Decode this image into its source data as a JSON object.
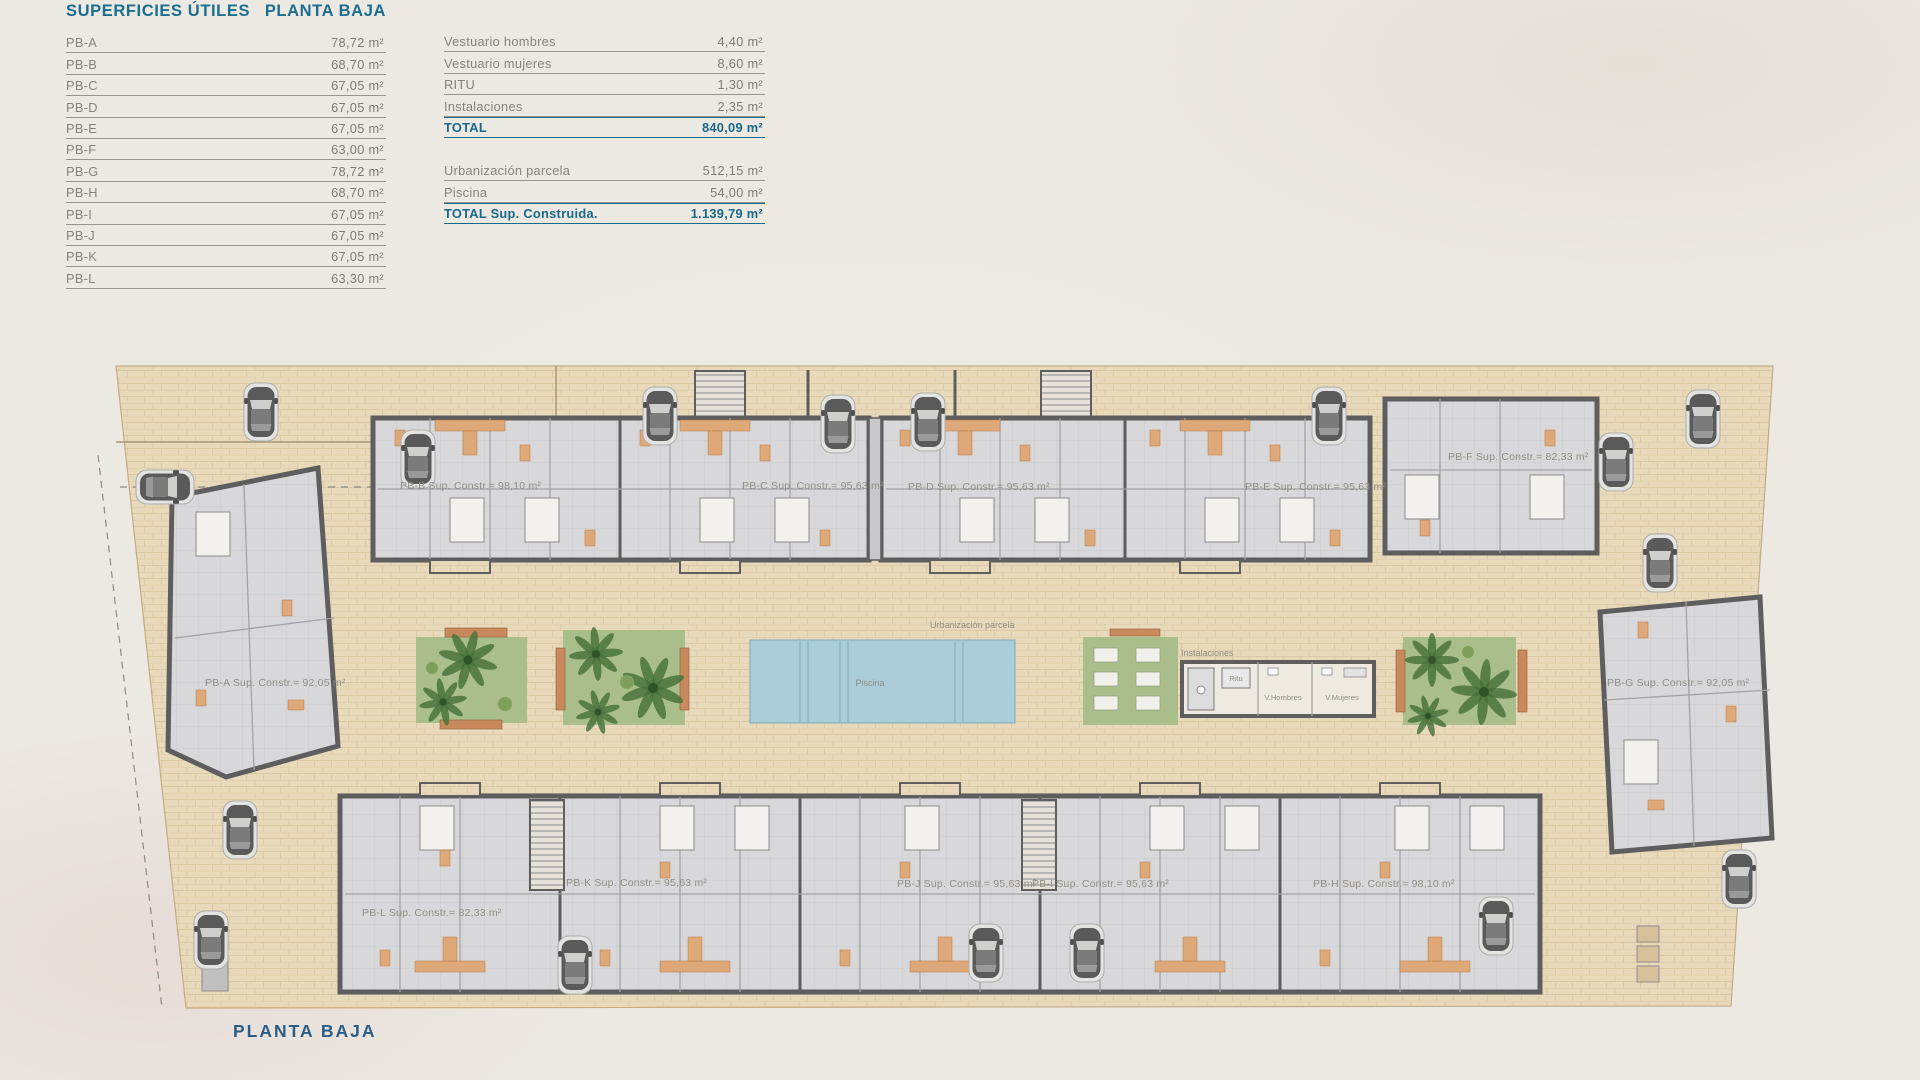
{
  "header": {
    "left": "SUPERFICIES ÚTILES",
    "right": "PLANTA BAJA"
  },
  "footer": {
    "title": "PLANTA BAJA"
  },
  "useful_areas": {
    "rows": [
      {
        "label": "PB-A",
        "value": "78,72 m²"
      },
      {
        "label": "PB-B",
        "value": "68,70 m²"
      },
      {
        "label": "PB-C",
        "value": "67,05 m²"
      },
      {
        "label": "PB-D",
        "value": "67,05 m²"
      },
      {
        "label": "PB-E",
        "value": "67,05 m²"
      },
      {
        "label": "PB-F",
        "value": "63,00 m²"
      },
      {
        "label": "PB-G",
        "value": "78,72 m²"
      },
      {
        "label": "PB-H",
        "value": "68,70 m²"
      },
      {
        "label": "PB-I",
        "value": "67,05 m²"
      },
      {
        "label": "PB-J",
        "value": "67,05 m²"
      },
      {
        "label": "PB-K",
        "value": "67,05 m²"
      },
      {
        "label": "PB-L",
        "value": "63,30 m²"
      }
    ]
  },
  "services": {
    "rows": [
      {
        "label": "Vestuario hombres",
        "value": "4,40 m²"
      },
      {
        "label": "Vestuario mujeres",
        "value": "8,60 m²"
      },
      {
        "label": "RITU",
        "value": "1,30 m²"
      },
      {
        "label": "Instalaciones",
        "value": "2,35 m²"
      }
    ],
    "total": {
      "label": "TOTAL",
      "value": "840,09 m²"
    }
  },
  "totals": {
    "rows": [
      {
        "label": "Urbanización parcela",
        "value": "512,15 m²"
      },
      {
        "label": "Piscina",
        "value": "54,00 m²"
      }
    ],
    "total": {
      "label": "TOTAL Sup. Construida.",
      "value": "1.139,79 m²"
    }
  },
  "plan": {
    "units": {
      "pb_a": "PB-A Sup. Constr.= 92,05 m²",
      "pb_b": "PB-B Sup. Constr.= 98,10 m²",
      "pb_c": "PB-C Sup. Constr.= 95,63 m²",
      "pb_d": "PB-D Sup. Constr.= 95,63 m²",
      "pb_e": "PB-E Sup. Constr.= 95,63 m²",
      "pb_f": "PB-F Sup. Constr.= 82,33 m²",
      "pb_g": "PB-G Sup. Constr.= 92,05 m²",
      "pb_h": "PB-H Sup. Constr.= 98,10 m²",
      "pb_i": "PB-I Sup. Constr.= 95,63 m²",
      "pb_j": "PB-J Sup. Constr.= 95,63 m²",
      "pb_k": "PB-K Sup. Constr.= 95,63 m²",
      "pb_l": "PB-L Sup. Constr.= 82,33 m²"
    },
    "labels": {
      "urbanizacion": "Urbanización parcela",
      "piscina": "Piscina",
      "instalaciones": "Instalaciones",
      "ritu": "Ritu",
      "v_hombres": "V.Hombres",
      "v_mujeres": "V.Mujeres"
    }
  },
  "colors": {
    "title_blue": "#1b6e91",
    "total_blue": "#18688c",
    "text_gray": "#85837c",
    "paving": "#e8d9ba",
    "pool_blue": "#abccd9",
    "green": "#a9be8b",
    "wall_gray": "#5e5e5e",
    "accent_orange": "#dfa878"
  }
}
